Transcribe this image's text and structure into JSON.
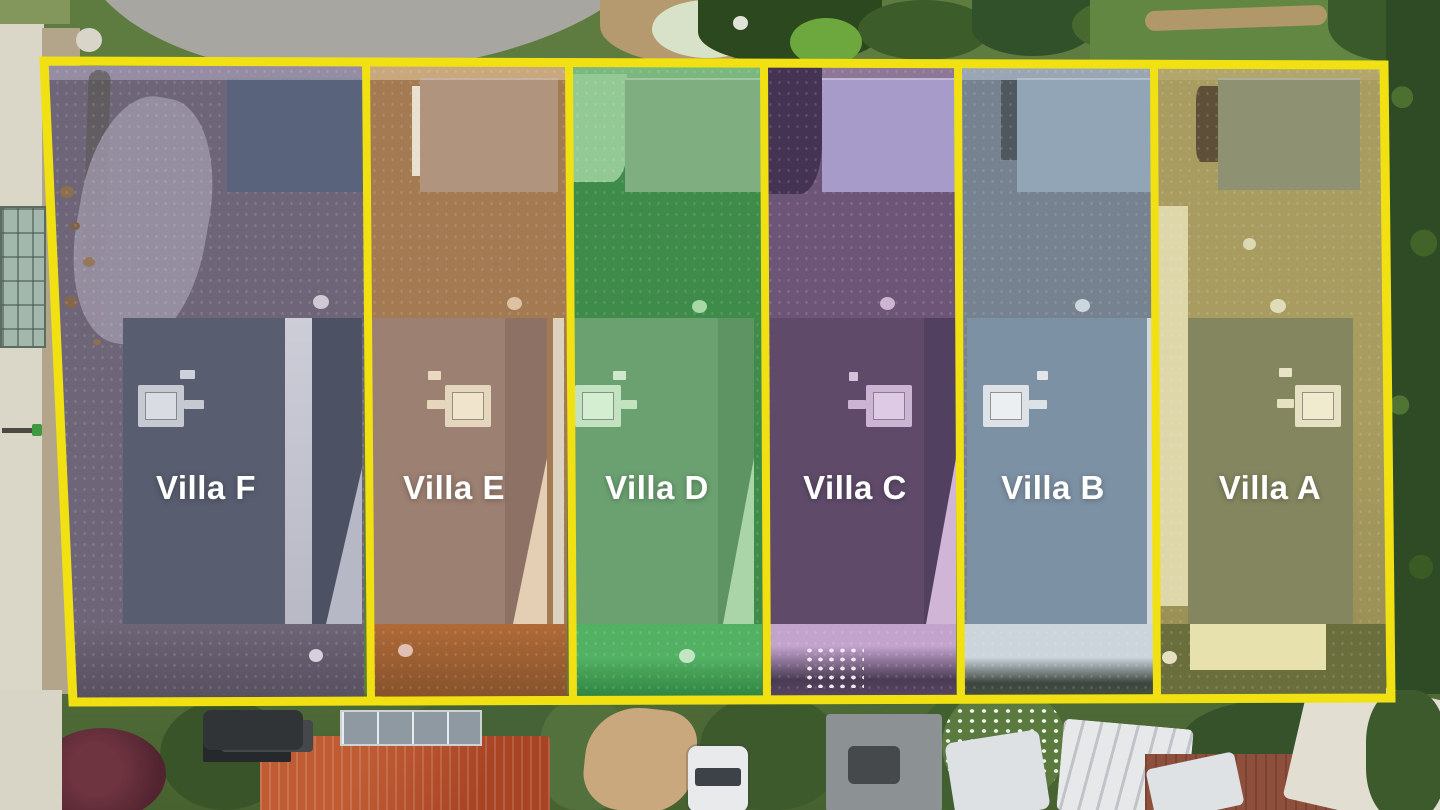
{
  "image": {
    "kind": "aerial-drone-site-plan",
    "description": "Top-down drone photo of a row of six newly built terraced villas, each plot outlined in yellow with a colored tint overlay and a white villa label",
    "boundary_color": "#f2e112",
    "label_text_color": "#ffffff"
  },
  "plots": [
    {
      "id": "F",
      "label": "Villa F",
      "tint": "#9890a8"
    },
    {
      "id": "E",
      "label": "Villa E",
      "tint": "#c98e5e"
    },
    {
      "id": "D",
      "label": "Villa D",
      "tint": "#4aa85a"
    },
    {
      "id": "C",
      "label": "Villa C",
      "tint": "#9a6fae"
    },
    {
      "id": "B",
      "label": "Villa B",
      "tint": "#94a9c4"
    },
    {
      "id": "A",
      "label": "Villa A",
      "tint": "#b3ae62"
    }
  ]
}
